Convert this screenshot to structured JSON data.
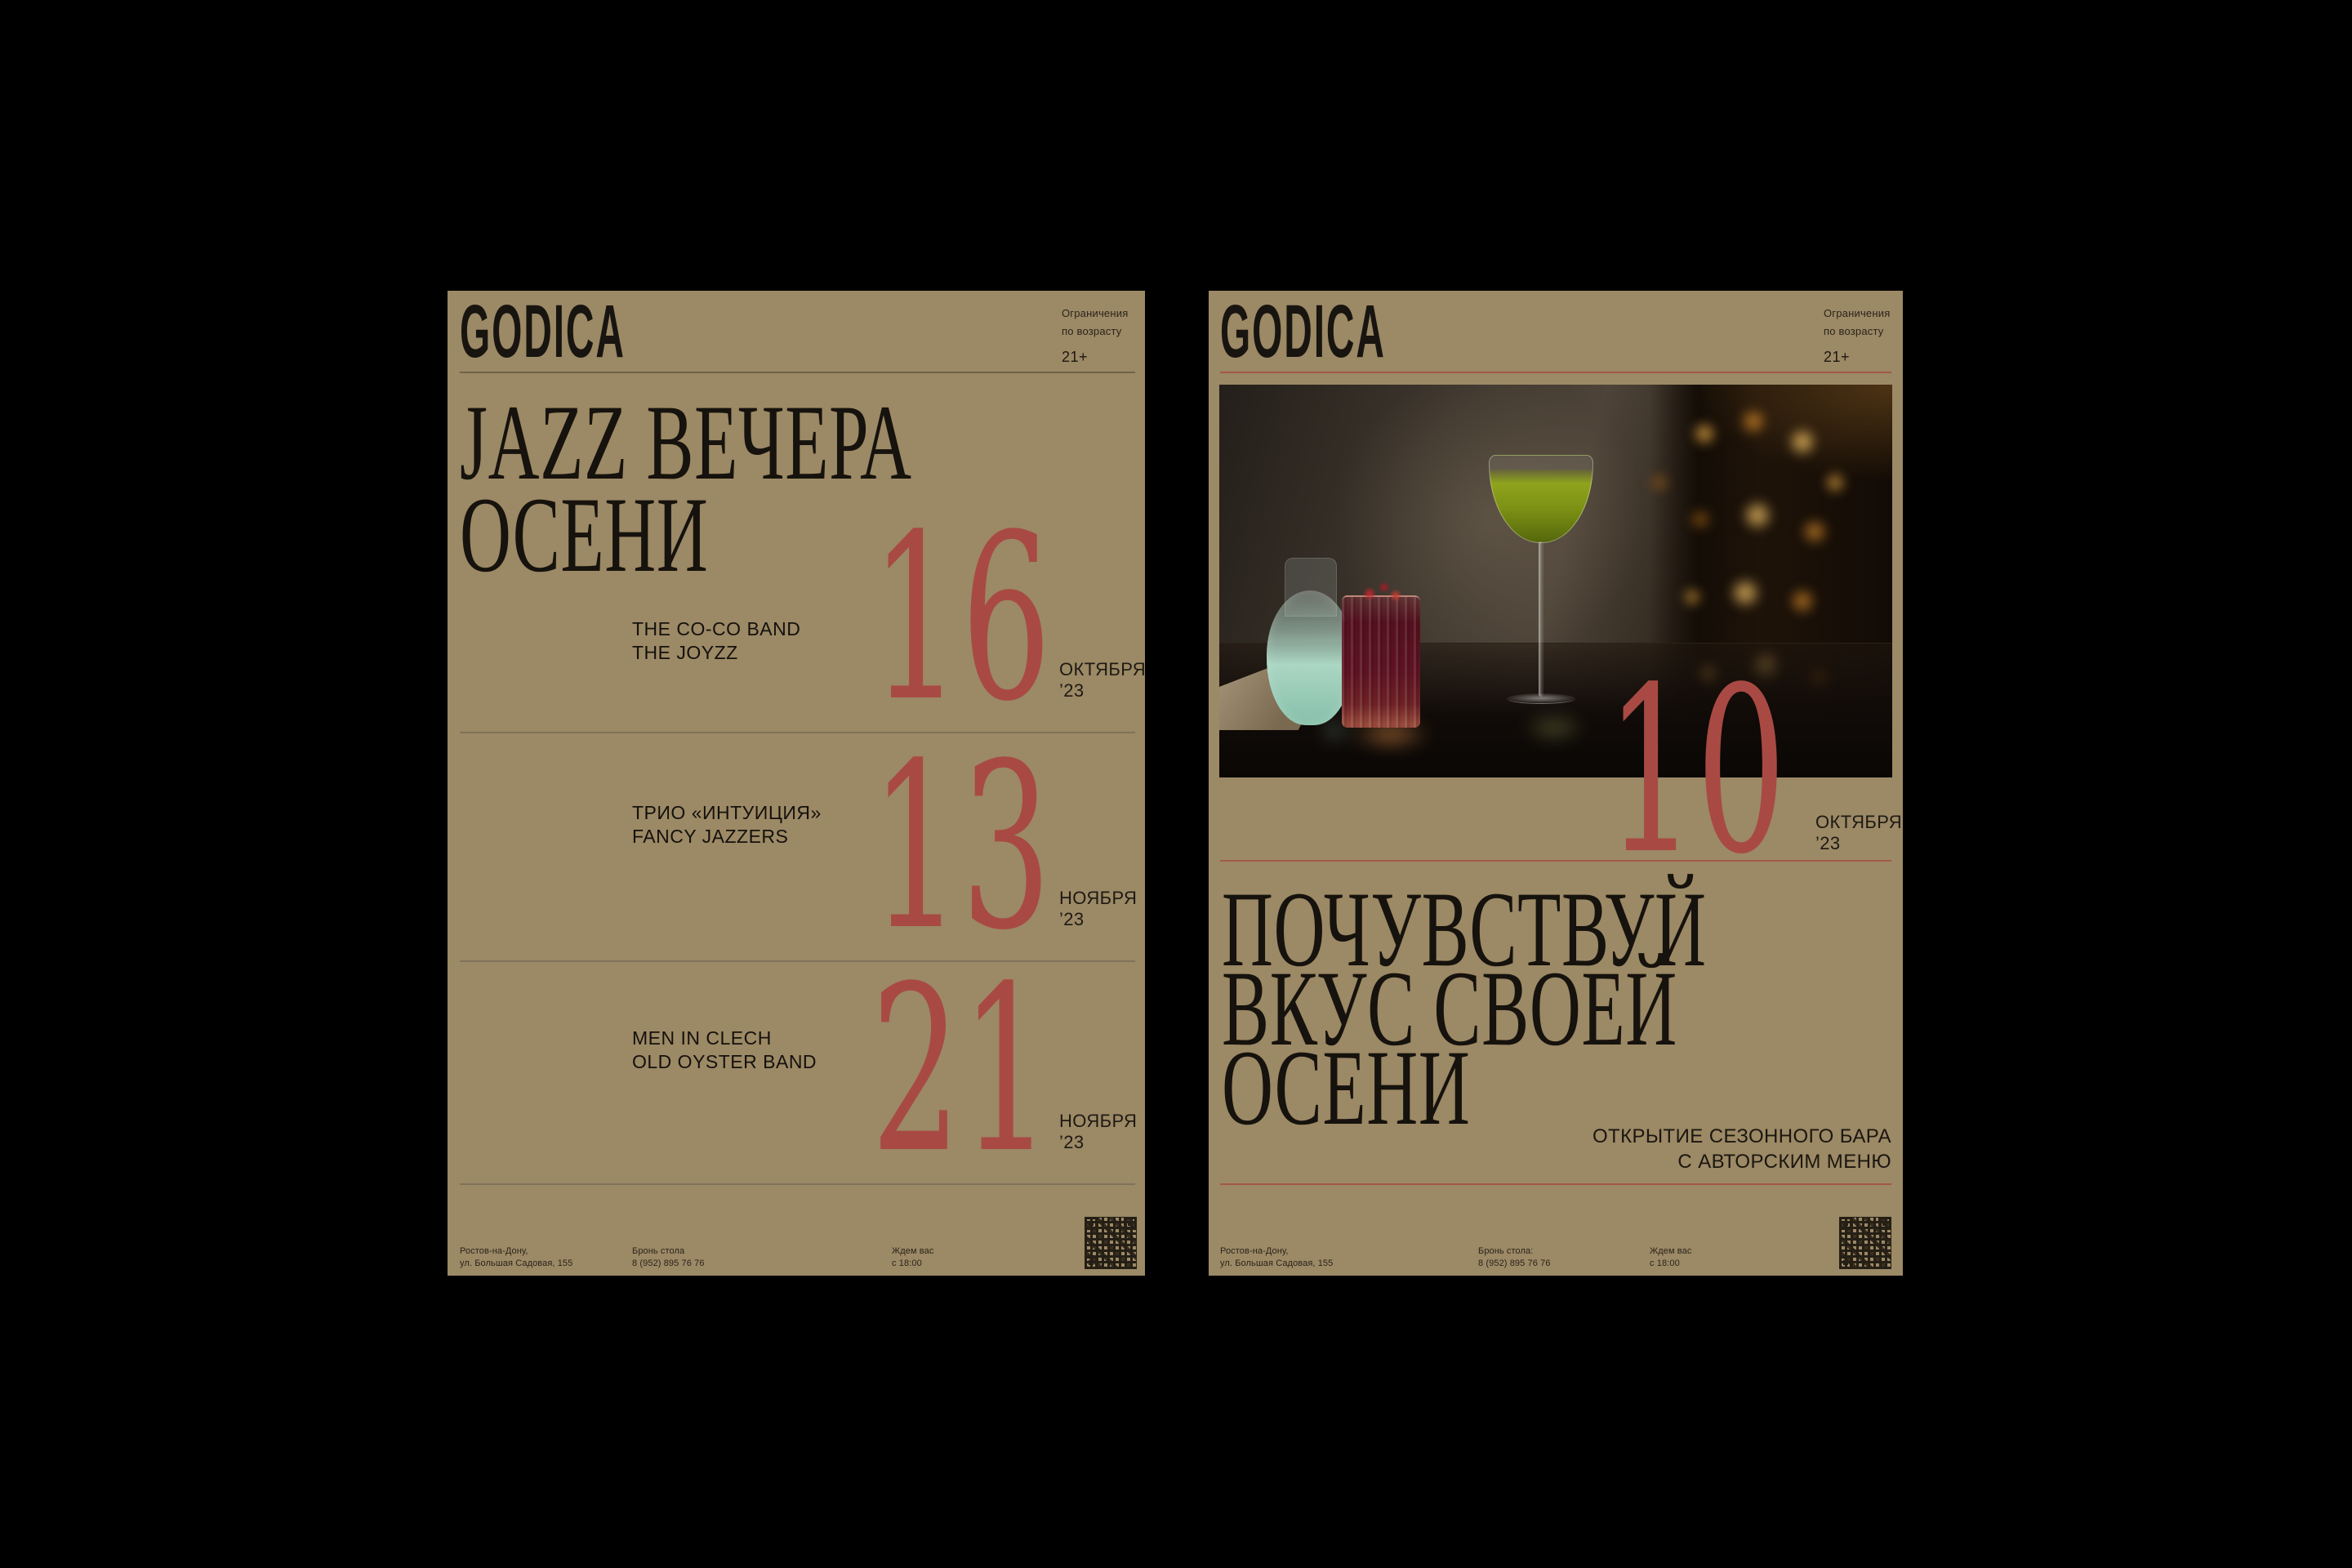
{
  "colors": {
    "canvas": "#000000",
    "poster_bg": "#9c8965",
    "text_dark": "#1c1812",
    "accent_red": "#a84a43",
    "rule_left": "#6f644a",
    "rule_right": "#a3584a"
  },
  "posters": {
    "left": {
      "logo": "GODICA",
      "age_restriction": {
        "line1": "Ограничения",
        "line2": "по возрасту",
        "badge": "21+"
      },
      "title_lines": [
        "JAZZ ВЕЧЕРА",
        "ОСЕНИ"
      ],
      "events": [
        {
          "lineup": [
            "THE CO-CO BAND",
            "THE JOYZZ"
          ],
          "day": "16",
          "month": "ОКТЯБРЯ",
          "year": "’23"
        },
        {
          "lineup": [
            "ТРИО «ИНТУИЦИЯ»",
            "FANCY JAZZERS"
          ],
          "day": "13",
          "month": "НОЯБРЯ",
          "year": "’23"
        },
        {
          "lineup": [
            "MEN IN CLECH",
            "OLD OYSTER BAND"
          ],
          "day": "21",
          "month": "НОЯБРЯ",
          "year": "’23"
        }
      ],
      "footer": {
        "address": [
          "Ростов-на-Дону,",
          "ул. Большая Садовая, 155"
        ],
        "booking": [
          "Бронь стола",
          "8 (952) 895 76 76"
        ],
        "hours": [
          "Ждем вас",
          "с 18:00"
        ]
      }
    },
    "right": {
      "logo": "GODICA",
      "age_restriction": {
        "line1": "Ограничения",
        "line2": "по возрасту",
        "badge": "21+"
      },
      "event": {
        "day": "10",
        "month": "ОКТЯБРЯ",
        "year": "’23"
      },
      "title_lines": [
        "ПОЧУВСТВУЙ",
        "ВКУС СВОЕЙ",
        "ОСЕНИ"
      ],
      "subtitle_lines": [
        "ОТКРЫТИЕ СЕЗОННОГО БАРА",
        "С АВТОРСКИМ МЕНЮ"
      ],
      "photo": {
        "description": "cocktails-on-bar-photo"
      },
      "footer": {
        "address": [
          "Ростов-на-Дону,",
          "ул. Большая Садовая, 155"
        ],
        "booking": [
          "Бронь стола:",
          "8 (952) 895 76 76"
        ],
        "hours": [
          "Ждем вас",
          "с 18:00"
        ]
      }
    }
  }
}
